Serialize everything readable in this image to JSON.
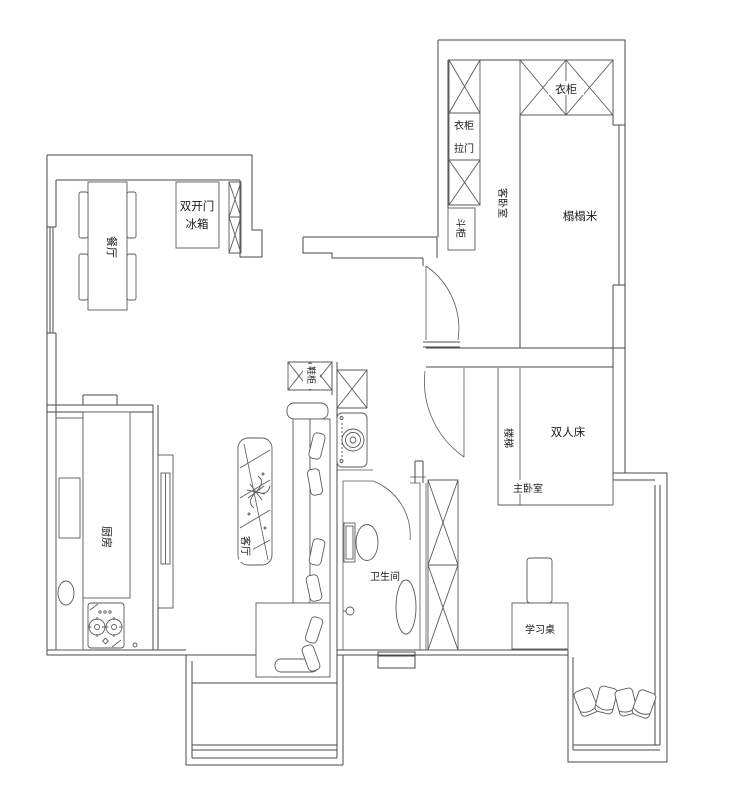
{
  "colors": {
    "line": "#4a4a4a",
    "furniture_line": "#5a5a5a",
    "text": "#1a1a1a",
    "background": "#ffffff"
  },
  "rooms": {
    "dining": {
      "label": "餐厅"
    },
    "kitchen": {
      "label": "厨房"
    },
    "living": {
      "label": "客厅"
    },
    "bathroom": {
      "label": "卫生间"
    },
    "master_bedroom": {
      "label": "主卧室"
    },
    "guest_bedroom": {
      "label": "客卧室"
    }
  },
  "furniture": {
    "fridge": {
      "line1": "双开门",
      "line2": "冰箱"
    },
    "shoe_cabinet": {
      "label": "鞋柜"
    },
    "bed": {
      "label": "双人床"
    },
    "ladder": {
      "label": "楼梯"
    },
    "desk": {
      "label": "学习桌"
    },
    "tatami": {
      "label": "榻榻米"
    },
    "wardrobe": {
      "label": "衣柜"
    },
    "wardrobe_sliding": {
      "line1": "衣柜",
      "line2": "拉门"
    },
    "chest": {
      "label": "斗柜"
    }
  }
}
